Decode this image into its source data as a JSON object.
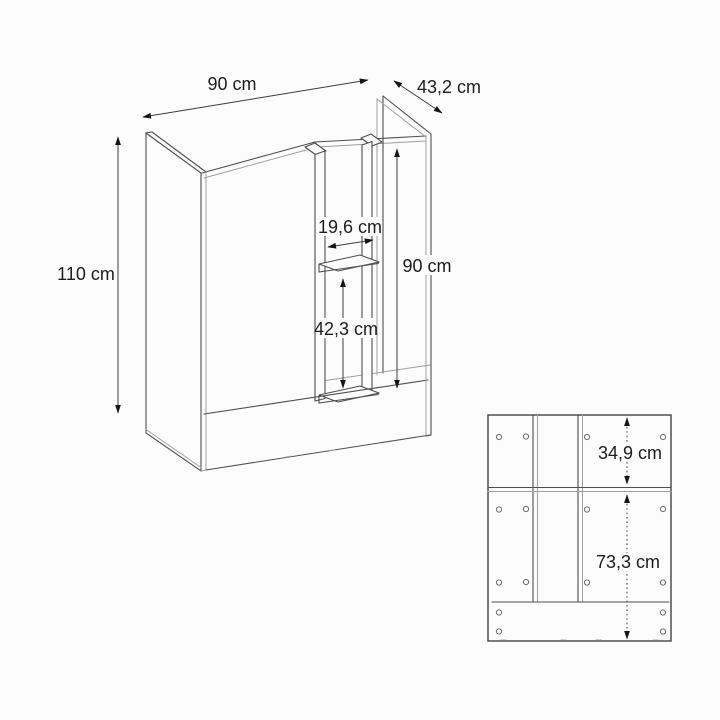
{
  "diagram": {
    "kind": "furniture-technical-drawing",
    "colors": {
      "line": "#4f4f4f",
      "secondary_line": "#9f9f9f",
      "dimension_line": "#3d3d3d",
      "text": "#1d1d1d",
      "background": "#fcfcfc"
    },
    "perspective_view": {
      "dims": {
        "width": "90 cm",
        "depth": "43,2 cm",
        "height": "110 cm",
        "niche_width": "19,6 cm",
        "inner_height": "90 cm",
        "shelf_spacing": "42,3 cm"
      }
    },
    "back_panel_view": {
      "dims": {
        "upper_section": "34,9 cm",
        "lower_section": "73,3 cm"
      }
    }
  }
}
